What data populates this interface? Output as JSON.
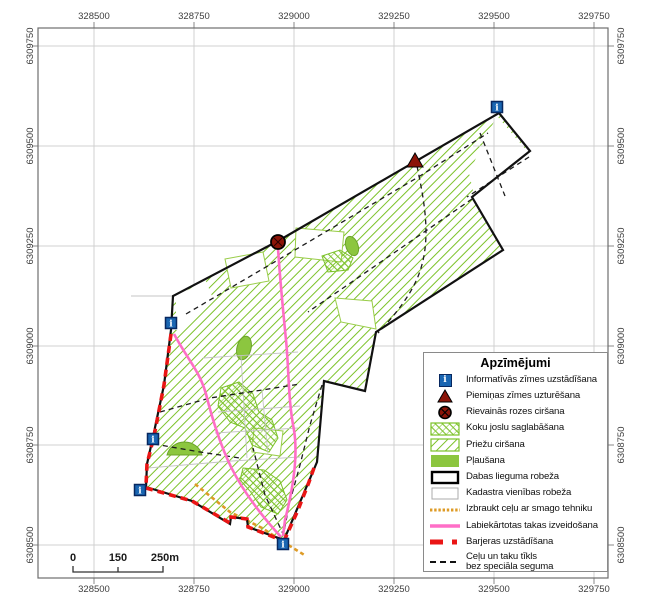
{
  "axes": {
    "x_ticks": [
      "328500",
      "328750",
      "329000",
      "329250",
      "329500",
      "329750"
    ],
    "y_ticks": [
      "6309750",
      "6309500",
      "6309250",
      "6309000",
      "6308750",
      "6308500"
    ]
  },
  "scalebar": {
    "start": "0",
    "mid": "150",
    "end": "250m"
  },
  "glyphs": {
    "info": "i"
  },
  "legend": {
    "title": "Apzīmējumi",
    "items": [
      {
        "icon": "info-sign",
        "label": "Informatīvās zīmes uzstādīšana"
      },
      {
        "icon": "memorial-triangle",
        "label": "Piemiņas zīmes uzturēšana"
      },
      {
        "icon": "rose-cut-circle",
        "label": "Rievainās rozes ciršana"
      },
      {
        "icon": "crosshatch-swatch",
        "label": "Koku joslu saglabāšana"
      },
      {
        "icon": "hatch-swatch",
        "label": "Priežu ciršana"
      },
      {
        "icon": "meadow-swatch",
        "label": "Pļaušana"
      },
      {
        "icon": "reserve-boundary-swatch",
        "label": "Dabas lieguma robeža"
      },
      {
        "icon": "cadastral-boundary-swatch",
        "label": "Kadastra vienības robeža"
      },
      {
        "icon": "orange-dashed-line",
        "label": "Izbraukt ceļu ar smago tehniku"
      },
      {
        "icon": "magenta-line",
        "label": "Labiekārtotas takas izveidošana"
      },
      {
        "icon": "red-dashes",
        "label": "Barjeras uzstādīšana"
      },
      {
        "icon": "black-dashed-line",
        "label": "Ceļu un taku tīkls",
        "label2": "bez speciāla seguma"
      }
    ]
  },
  "colors": {
    "hatch_green": "#7CC229",
    "meadow_green": "#8CC63F",
    "info_blue": "#1A66B2",
    "dark_red": "#8B1408",
    "barrier_red": "#EA1515",
    "trail_magenta": "#FF6EC7",
    "heavy_route_orange": "#DE9B26",
    "boundary_black": "#111111",
    "grid_gray": "#D0D0D0"
  }
}
